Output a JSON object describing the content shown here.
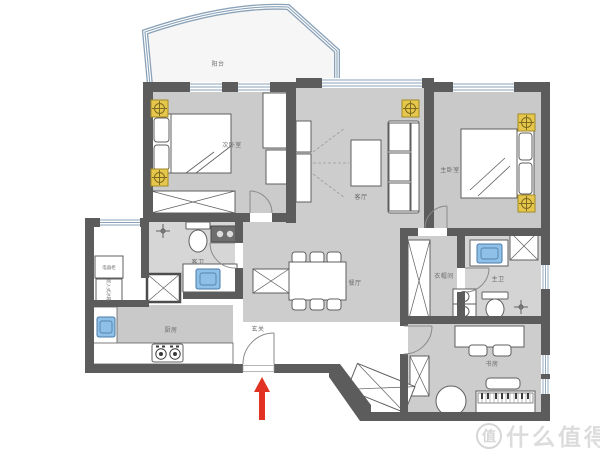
{
  "plan": {
    "rooms": {
      "balcony": "阳台",
      "bedroom_secondary": "次卧室",
      "living": "客厅",
      "bedroom_master": "主卧室",
      "closet": "衣帽间",
      "bath_master": "主卫",
      "study": "书房",
      "dining": "餐厅",
      "entry": "玄关",
      "kitchen": "厨房",
      "bath_guest": "客卫"
    },
    "cabinets": {
      "appliance": "电器柜",
      "fridge": "嵌入式冰箱"
    },
    "colors": {
      "wall": "#5c5c5c",
      "floor": "#cdcdcd",
      "window": "#8aa2b8",
      "ceiling_light": "#e7c64c",
      "sink": "#8fc1e8",
      "entrance_arrow": "#e23222",
      "watermark": "#dcdcdc"
    }
  },
  "watermark": {
    "logo_char": "值",
    "text": "什么值得买"
  }
}
